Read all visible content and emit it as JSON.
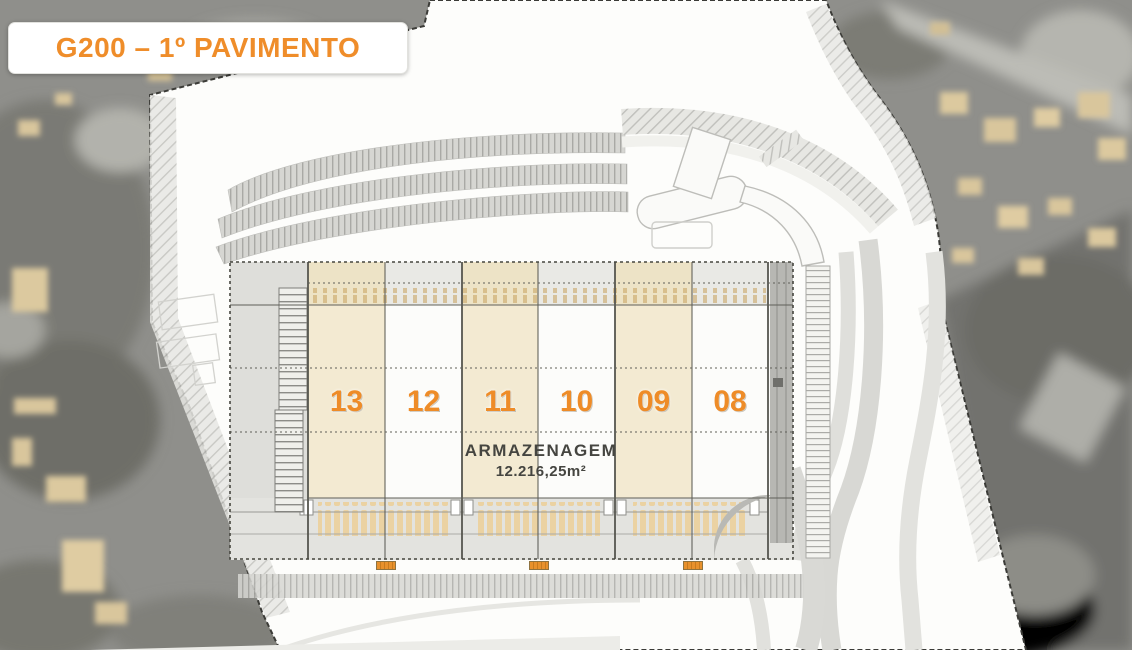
{
  "title": "G200 – 1º PAVIMENTO",
  "plan": {
    "floor_name": "1º PAVIMENTO",
    "project_code": "G200",
    "building": {
      "modules": [
        {
          "label": "13",
          "highlighted": true
        },
        {
          "label": "12",
          "highlighted": false
        },
        {
          "label": "11",
          "highlighted": true
        },
        {
          "label": "10",
          "highlighted": false
        },
        {
          "label": "09",
          "highlighted": true
        },
        {
          "label": "08",
          "highlighted": false
        }
      ],
      "area_label": "ARMAZENAGEM",
      "area_value": "12.216,25m²"
    },
    "dock_markers": 3
  },
  "colors": {
    "accent_orange": "#EE8C28",
    "title_orange": "#EF8D2A",
    "module_highlight_beige": "#F3EAD2",
    "module_plain_white": "#FCFCFA",
    "site_white": "#FDFDFB",
    "aerial_photo_gray": "#8F8F8B",
    "photo_building_tan": "#D9C69C",
    "plan_line_dark": "#4A4A46"
  }
}
